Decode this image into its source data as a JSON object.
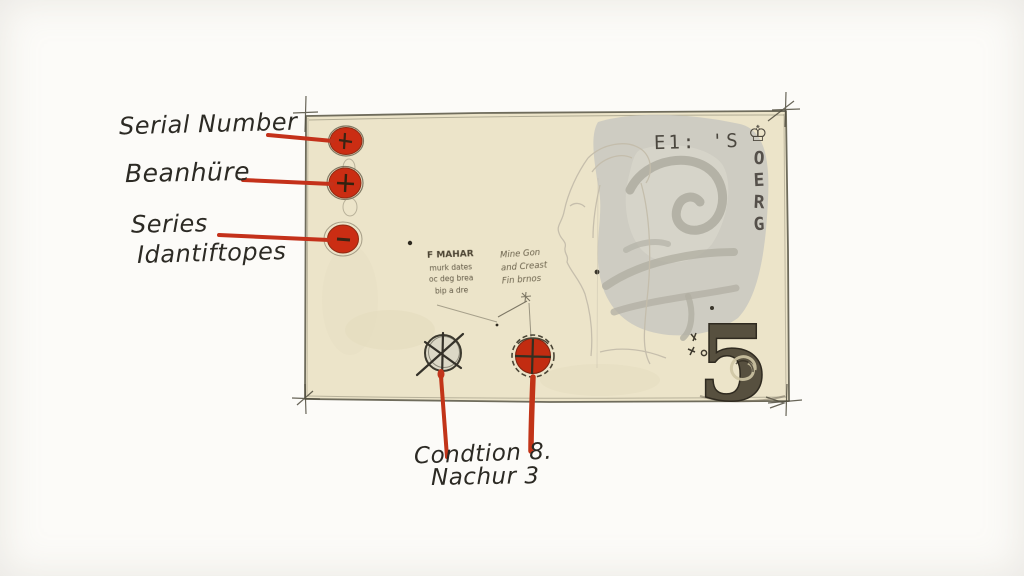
{
  "labels": {
    "serial_number": "Serial Number",
    "signature": "Beanhüre",
    "series_line1": "Series",
    "series_line2": "Idantiftopes",
    "condition_line1": "Condtion 8.",
    "condition_line2": "Nachur 3"
  },
  "note": {
    "header_text": "E1: 'S",
    "crown_icon": "♔",
    "vertical_letters": [
      "O",
      "E",
      "R",
      "G"
    ],
    "denomination": "5",
    "microtext_left": [
      "F MAHAR",
      "murk dates",
      "oc deg brea",
      "bip a dre"
    ],
    "microtext_right": [
      "Mine Gon",
      "and Creast",
      "Fin brnos"
    ]
  },
  "colors": {
    "accent_red": "#c4311a",
    "paper": "#ece4c9",
    "watermark_gray": "#c9c8c0",
    "ink": "#2c2a24"
  }
}
